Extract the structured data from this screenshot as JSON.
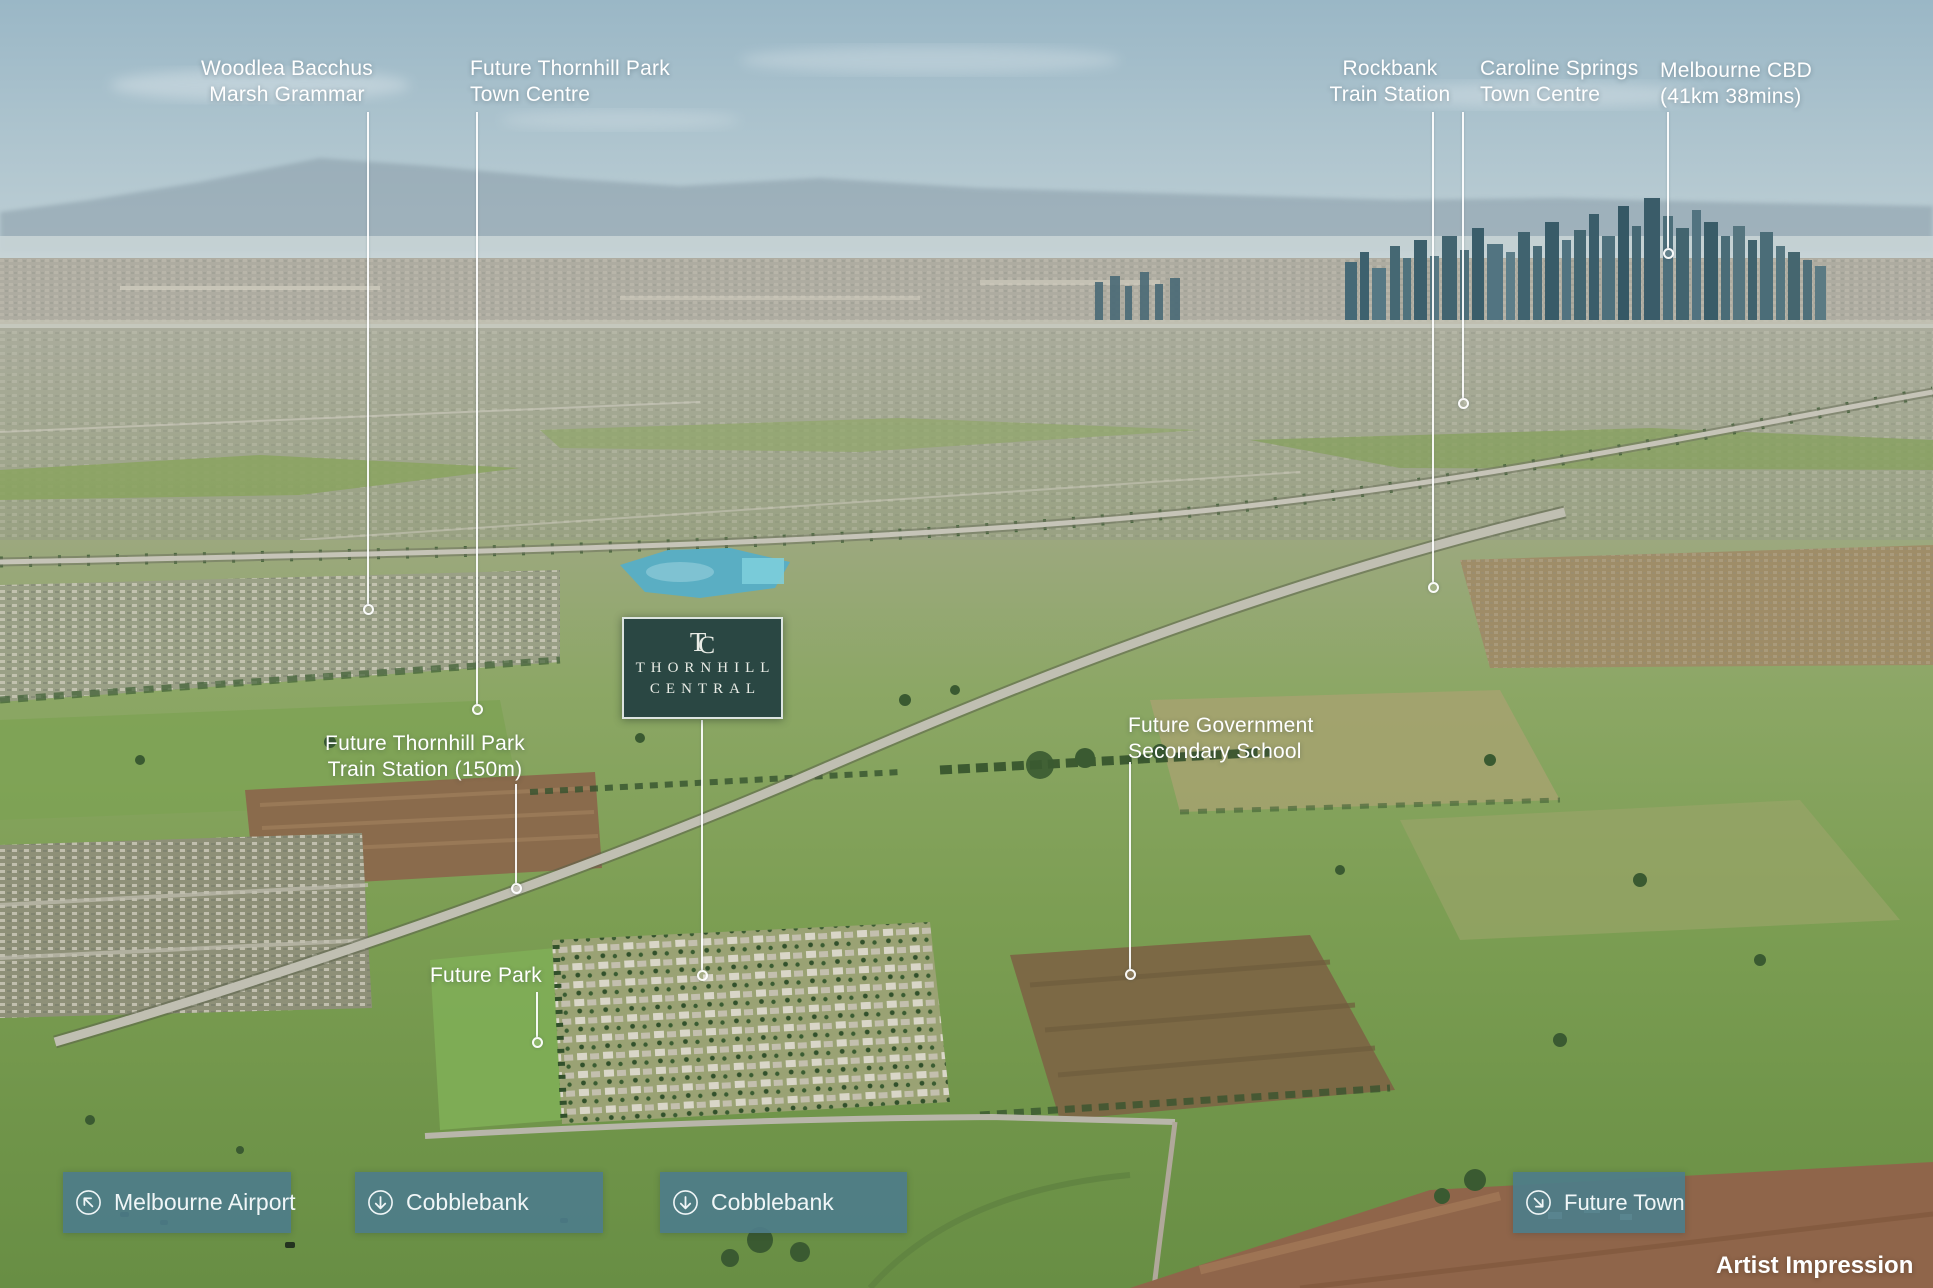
{
  "callouts": [
    {
      "name": "woodlea-bacchus-marsh-grammar",
      "line1": "Woodlea Bacchus",
      "line2": "Marsh Grammar"
    },
    {
      "name": "future-thornhill-park-town-centre",
      "line1": "Future Thornhill Park",
      "line2": "Town Centre"
    },
    {
      "name": "rockbank-train-station",
      "line1": "Rockbank",
      "line2": "Train Station"
    },
    {
      "name": "caroline-springs-town-centre",
      "line1": "Caroline Springs",
      "line2": "Town Centre"
    },
    {
      "name": "melbourne-cbd",
      "line1": "Melbourne CBD",
      "line2": "(41km 38mins)"
    },
    {
      "name": "future-thornhill-park-train-station",
      "line1": "Future Thornhill Park",
      "line2": "Train Station (150m)"
    },
    {
      "name": "future-government-secondary-school",
      "line1": "Future Government",
      "line2": "Secondary School"
    },
    {
      "name": "future-park",
      "line1": "Future Park"
    }
  ],
  "logo": {
    "monogram_t": "T",
    "monogram_c": "C",
    "line1": "THORNHILL",
    "line2": "CENTRAL"
  },
  "buttons": [
    {
      "label": "Melbourne Airport",
      "direction": "up-left"
    },
    {
      "label": "Cobblebank",
      "direction": "down"
    },
    {
      "label": "Cobblebank",
      "direction": "down"
    },
    {
      "label": "Future Town",
      "direction": "down-right"
    }
  ],
  "footer": {
    "note": "Artist Impression"
  },
  "colors": {
    "button_teal": "#4e7d89",
    "logo_green": "#2a4743",
    "label_white": "#ffffff"
  }
}
